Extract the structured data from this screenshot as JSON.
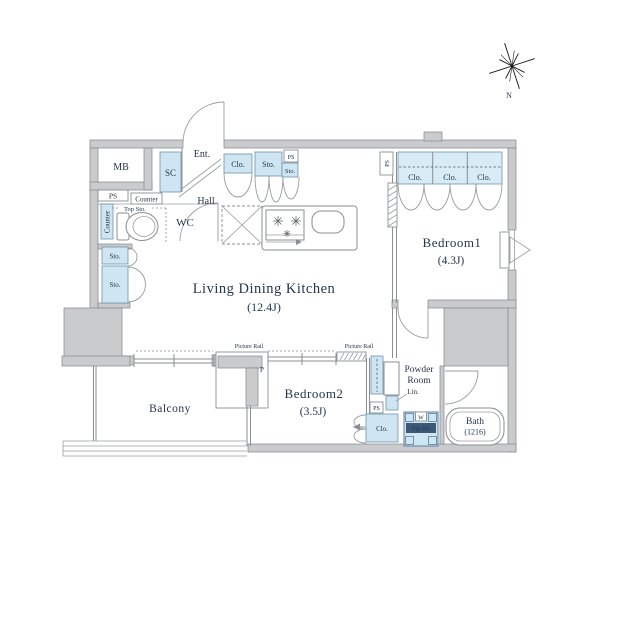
{
  "plan": {
    "rooms": {
      "ldk": {
        "name": "Living Dining Kitchen",
        "size": "(12.4J)"
      },
      "bedroom1": {
        "name": "Bedroom1",
        "size": "(4.3J)"
      },
      "bedroom2": {
        "name": "Bedroom2",
        "size": "(3.5J)"
      },
      "balcony": {
        "name": "Balcony"
      },
      "bath": {
        "name": "Bath",
        "size": "(1216)"
      },
      "powder_room": {
        "line1": "Powder",
        "line2": "Room"
      },
      "wc": {
        "name": "WC"
      },
      "hall": {
        "name": "Hall"
      },
      "entrance": {
        "name": "Ent."
      },
      "meter_box": {
        "name": "MB"
      }
    },
    "fixtures": {
      "closet": "Clo.",
      "storage": "Sto.",
      "shoe_closet": "SC",
      "linen": "Lin.",
      "pipe_space": "PS",
      "counter": "Counter",
      "top_storage": "Top Sto.",
      "washer": "W",
      "pillar": "P",
      "picture_rail": "Picture Rail"
    },
    "compass": {
      "north": "N"
    },
    "colors": {
      "fixture_fill": "#cfe5f2",
      "closet_fill": "#d8ecf6",
      "wall_fill": "#c9cbcd",
      "line": "#8b8e92",
      "text": "#24364d",
      "washer_band": "#3c5a77"
    }
  }
}
